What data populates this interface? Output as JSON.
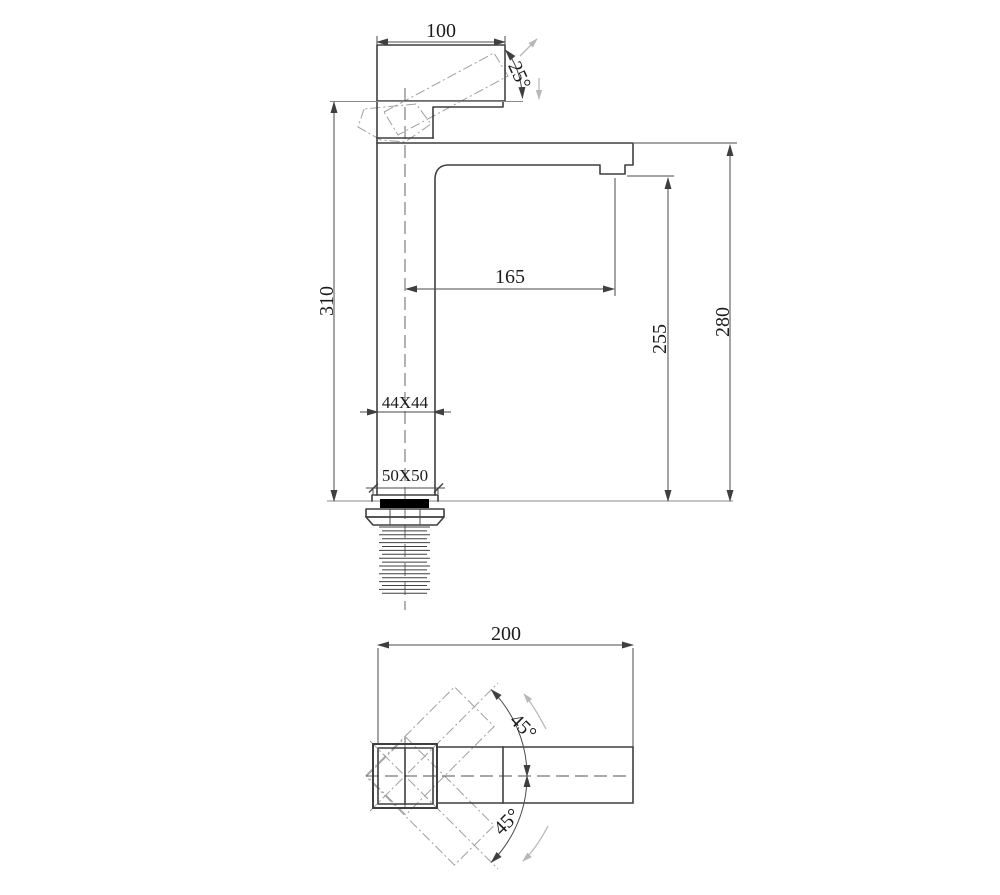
{
  "labels": {
    "side_view": {
      "handle_width": "100",
      "handle_angle": "25°",
      "overall_height": "310",
      "spout_reach": "165",
      "outlet_height": "255",
      "spout_top_height": "280",
      "body_section": "44X44",
      "base_section": "50X50"
    },
    "top_view": {
      "overall_length": "200",
      "swivel_angle_upper": "45°",
      "swivel_angle_lower": "45°"
    }
  },
  "colors": {
    "outline": "#3f3f3f",
    "dimension": "#4a4a4a",
    "extension_gray": "#8a8a8a",
    "phantom": "#9f9f9f",
    "motion_arrow": "#b8b8b8",
    "gasket": "#000000",
    "background": "#ffffff"
  }
}
